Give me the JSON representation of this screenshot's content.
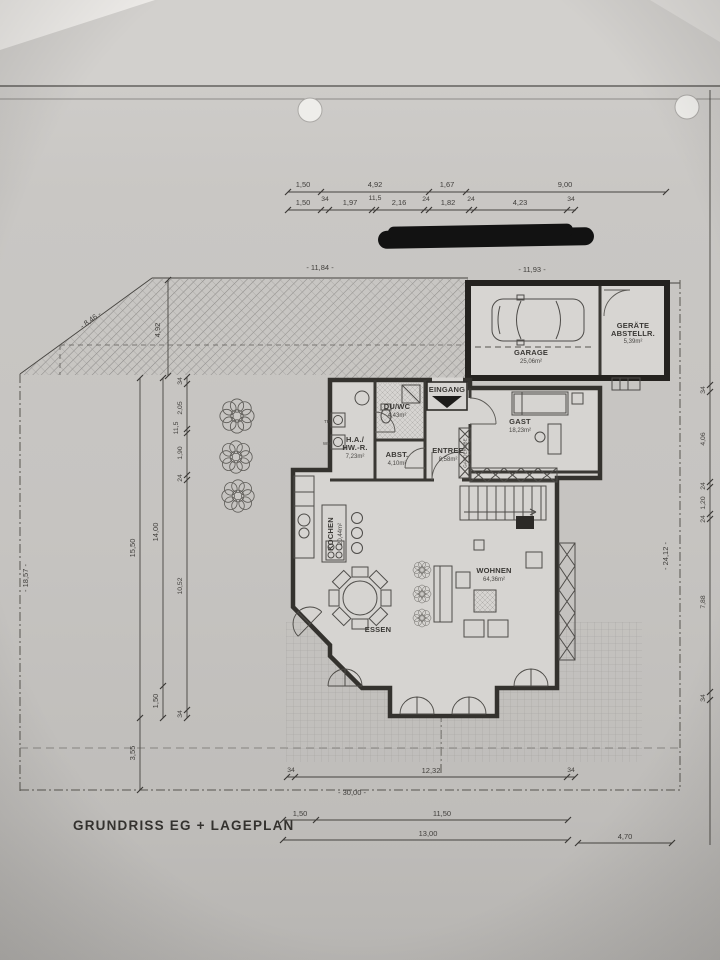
{
  "title": "GRUNDRISS EG + LAGEPLAN",
  "colors": {
    "paper": "#c9c7c4",
    "ink": "#3a3835",
    "redaction": "#111111"
  },
  "dims": {
    "top1": [
      "1,50",
      "4,92",
      "1,67",
      "9,00"
    ],
    "top2": [
      "1,50",
      "34",
      "1,97",
      "11,5",
      "2,16",
      "24",
      "1,82",
      "24",
      "4,23",
      "34"
    ],
    "site": {
      "top_left": "- 11,84 -",
      "top_right": "- 11,93 -",
      "diagonal": "- 8,46 -",
      "left_height": "4,92",
      "left_total": "- 18,57 -",
      "right_total": "- 24,12 -",
      "bottom_total": "- 30,00 -"
    },
    "left_outer": [
      "15,50",
      "3,55"
    ],
    "left_mid": [
      "14,00",
      "1,50"
    ],
    "left_inner": [
      "34",
      "2,05",
      "11,5",
      "1,90",
      "24",
      "10,52",
      "34"
    ],
    "right": [
      "34",
      "4,06",
      "24",
      "1,20",
      "24",
      "7,88",
      "34"
    ],
    "bottom1": [
      "34",
      "12,32",
      "34"
    ],
    "bottom2": [
      "1,50",
      "11,50"
    ],
    "bottom3": "13,00",
    "bottom4": "4,70"
  },
  "rooms": {
    "garage": {
      "name": "GARAGE",
      "area": "25,06m²"
    },
    "geraete": {
      "name": "GERÄTE",
      "name2": "ABSTELLR.",
      "area": "5,39m²"
    },
    "eingang": {
      "name": "EINGANG"
    },
    "duwc": {
      "name": "DU/WC",
      "area": "4,43m²"
    },
    "hawr": {
      "name": "H.A./",
      "name2": "HW.-R.",
      "area": "7,23m²"
    },
    "abst": {
      "name": "ABST.",
      "area": "4,10m²"
    },
    "entree": {
      "name": "ENTREE",
      "area": "8,58m²"
    },
    "gast": {
      "name": "GAST",
      "area": "18,23m²"
    },
    "kochen": {
      "name": "KOCHEN",
      "area": "20,44m²"
    },
    "essen": {
      "name": "ESSEN"
    },
    "wohnen": {
      "name": "WOHNEN",
      "area": "64,36m²"
    },
    "garderobe": "GARDEROBE",
    "tr": "TR",
    "wm": "WM"
  }
}
